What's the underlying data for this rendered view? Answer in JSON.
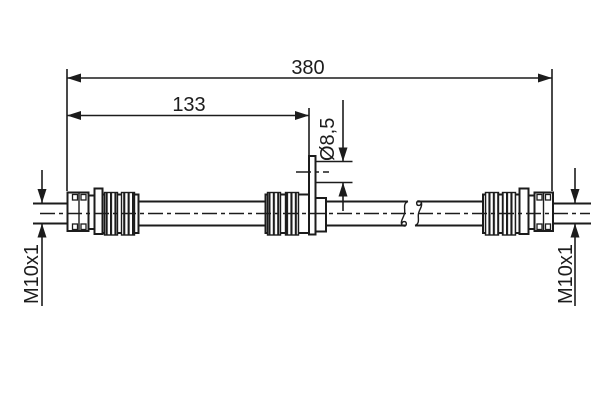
{
  "colors": {
    "background": "#ffffff",
    "line": "#1c1c1c"
  },
  "drawing": {
    "labels": {
      "overall_length": "380",
      "left_section_length": "133",
      "hole_diameter": "Ø8,5",
      "left_thread": "M10x1",
      "right_thread": "M10x1"
    }
  }
}
